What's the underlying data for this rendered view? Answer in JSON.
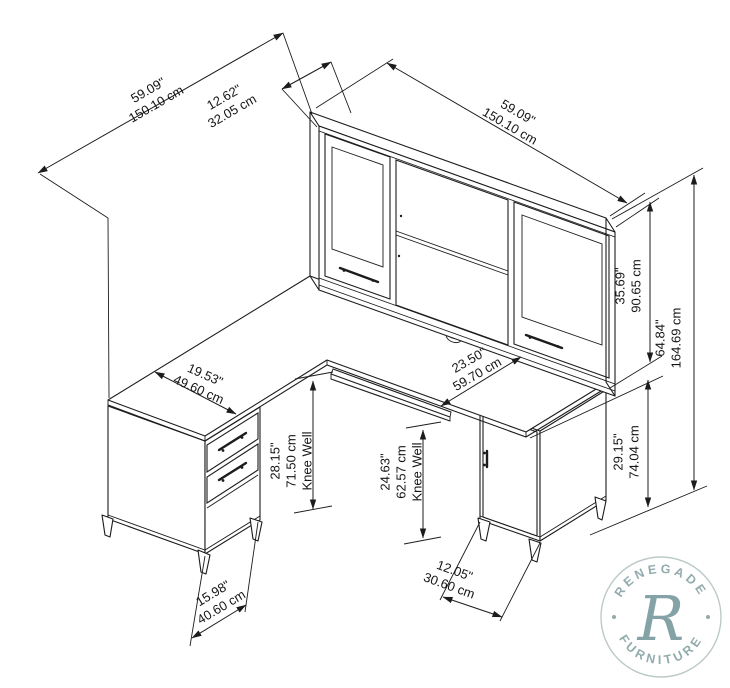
{
  "diagram": {
    "title": "L-shaped desk with hutch dimension drawing",
    "dimensions": [
      {
        "id": "return-length",
        "inches": "59.09\"",
        "cm": "150.10 cm"
      },
      {
        "id": "hutch-depth",
        "inches": "12.62\"",
        "cm": "32.05 cm"
      },
      {
        "id": "hutch-width",
        "inches": "59.09\"",
        "cm": "150.10 cm"
      },
      {
        "id": "hutch-height",
        "inches": "35.69\"",
        "cm": "90.65 cm"
      },
      {
        "id": "total-height",
        "inches": "64.84\"",
        "cm": "164.69 cm"
      },
      {
        "id": "desk-height",
        "inches": "29.15\"",
        "cm": "74.04 cm"
      },
      {
        "id": "desk-depth",
        "inches": "23.50\"",
        "cm": "59.70 cm"
      },
      {
        "id": "return-width",
        "inches": "19.53\"",
        "cm": "49.60 cm"
      },
      {
        "id": "knee-well-left",
        "inches": "28.15\"",
        "cm": "71.50 cm",
        "note": "Knee Well"
      },
      {
        "id": "knee-well-right",
        "inches": "24.63\"",
        "cm": "62.57 cm",
        "note": "Knee Well"
      },
      {
        "id": "cabinet-width",
        "inches": "12.05\"",
        "cm": "30.60 cm"
      },
      {
        "id": "pedestal-width",
        "inches": "15.98\"",
        "cm": "40.60 cm"
      }
    ],
    "watermark": {
      "top": "RENEGADE",
      "bottom": "FURNITURE",
      "monogram": "R"
    },
    "colors": {
      "line": "#1c1c1c",
      "watermark": "#92abad",
      "background": "#ffffff"
    }
  }
}
